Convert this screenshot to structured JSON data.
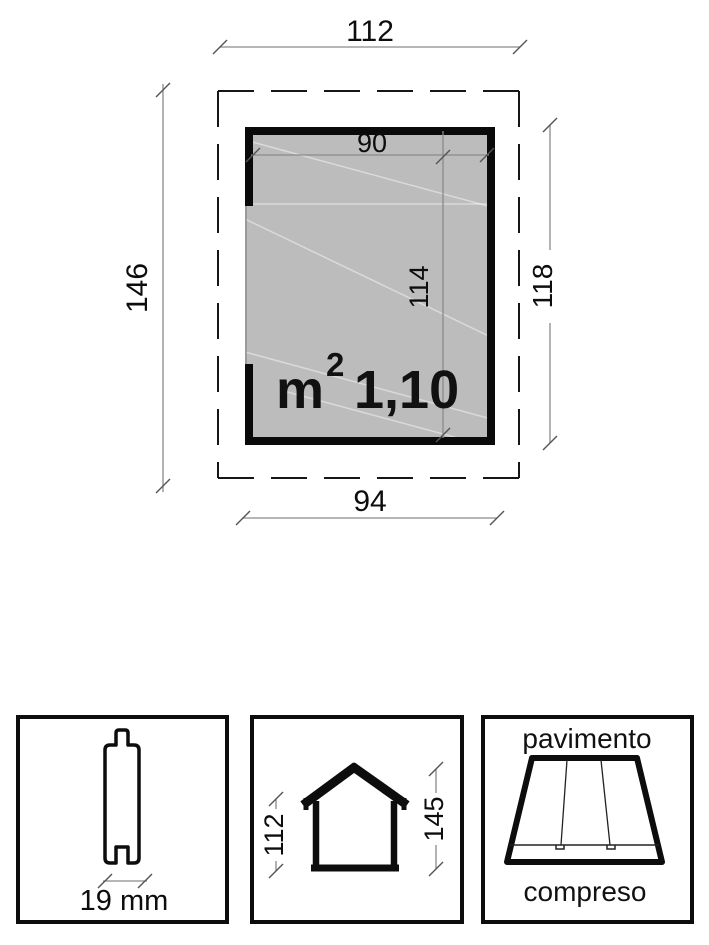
{
  "colors": {
    "room_fill": "#bcbcbc",
    "line_black": "#111111",
    "dim_gray": "#8a8a8a"
  },
  "plan": {
    "dim_top_width": "112",
    "dim_left_height": "146",
    "dim_inner_width": "90",
    "dim_inner_depth": "114",
    "dim_right_depth": "118",
    "dim_bottom_width": "94",
    "area": {
      "unit": "m",
      "exponent": "2",
      "value": "1,10"
    }
  },
  "details": {
    "plank": {
      "thickness": "19 mm"
    },
    "elevation": {
      "dim_wall_height": "112",
      "dim_ridge_height": "145"
    },
    "floor": {
      "caption_line1": "pavimento",
      "caption_line2": "compreso"
    }
  }
}
